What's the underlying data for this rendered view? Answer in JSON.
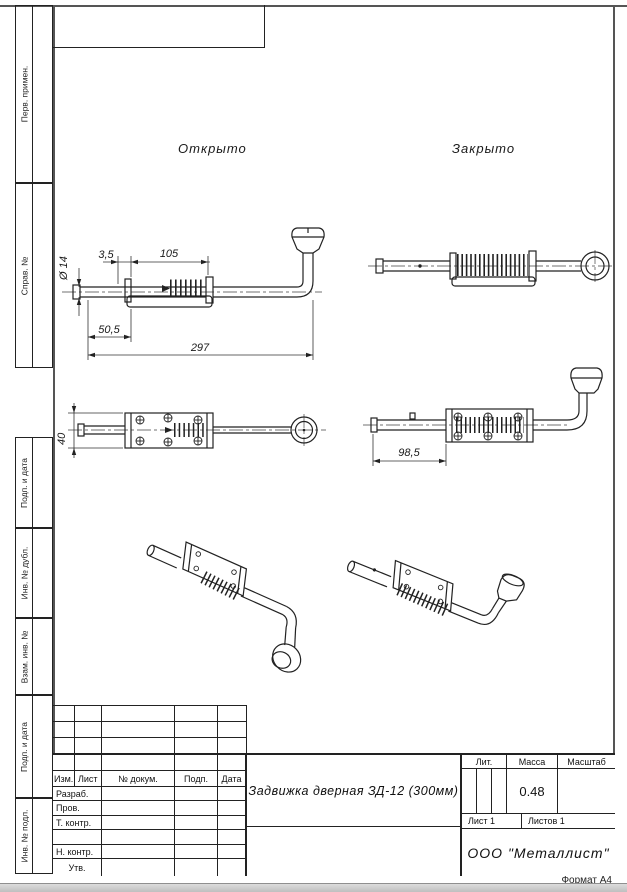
{
  "sheet": {
    "format": "Формат А4",
    "company": "ООО  \"Металлист\"",
    "title": "Задвижка дверная ЗД-12 (300мм)"
  },
  "margin": {
    "labels": [
      "Перв. примен.",
      "Справ. №",
      "Подп. и дата",
      "Инв. № дубл.",
      "Взам. инв. №",
      "Подп. и дата",
      "Инв. № подл."
    ]
  },
  "views": {
    "open": "Открыто",
    "closed": "Закрыто"
  },
  "dims": {
    "dia14": "Ø 14",
    "d35": "3,5",
    "d105": "105",
    "d505": "50,5",
    "d297": "297",
    "d40": "40",
    "d985": "98,5"
  },
  "titleblock": {
    "cols": {
      "izm": "Изм.",
      "list": "Лист",
      "doc": "№ докум.",
      "podp": "Подп.",
      "data": "Дата"
    },
    "roles": {
      "razrab": "Разраб.",
      "prov": "Пров.",
      "tkontr": "Т. контр.",
      "nkontr": "Н. контр.",
      "utv": "Утв."
    },
    "lit": "Лит.",
    "massa": "Масса",
    "masshtab": "Масштаб",
    "massa_value": "0.48",
    "sheet_no": "Лист 1",
    "sheets_total": "Листов 1"
  }
}
